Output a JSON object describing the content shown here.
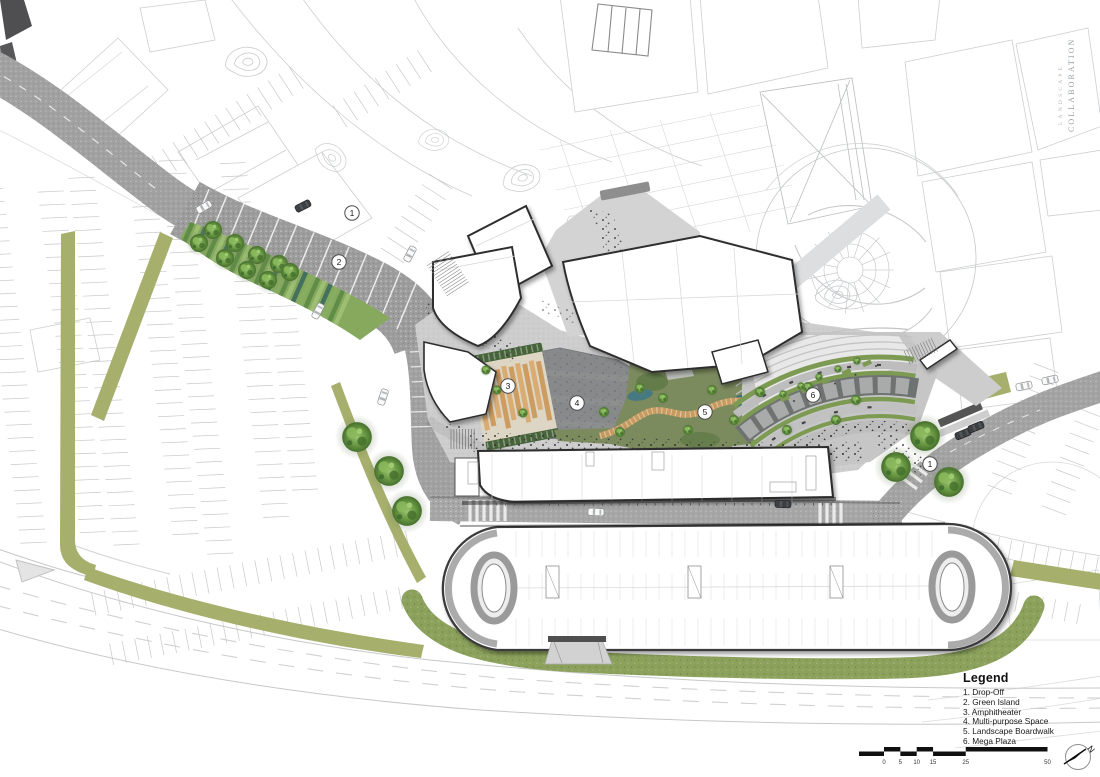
{
  "sheet": {
    "studio_line1": "LANDSCAPE",
    "studio_line2": "COLLABORATION"
  },
  "legend": {
    "title": "Legend",
    "items": [
      "1. Drop-Off",
      "2. Green Island",
      "3. Amphitheater",
      "4. Multi-purpose Space",
      "5. Landscape Boardwalk",
      "6. Mega Plaza"
    ]
  },
  "scale_bar": {
    "unit_ticks": [
      "0",
      "5",
      "10",
      "15",
      "25",
      "50"
    ]
  },
  "north_arrow": {
    "label": "N"
  },
  "plan_markers": [
    {
      "label": "1",
      "x": 352,
      "y": 213
    },
    {
      "label": "2",
      "x": 339,
      "y": 262
    },
    {
      "label": "3",
      "x": 508,
      "y": 386
    },
    {
      "label": "4",
      "x": 577,
      "y": 403
    },
    {
      "label": "5",
      "x": 705,
      "y": 412
    },
    {
      "label": "6",
      "x": 813,
      "y": 395
    },
    {
      "label": "1",
      "x": 930,
      "y": 464
    }
  ],
  "colors": {
    "olive_green": "#a6b06c",
    "tree_green": "#6a9a44",
    "road_gray": "#a0a0a0",
    "plaza_gray": "#cdcdcd",
    "dark_plaza_gray": "#87898a",
    "boardwalk_tan": "#c79a5f",
    "water_teal": "#44767c",
    "building_outline": "#2e2e2e",
    "context_line": "#ccced0"
  }
}
